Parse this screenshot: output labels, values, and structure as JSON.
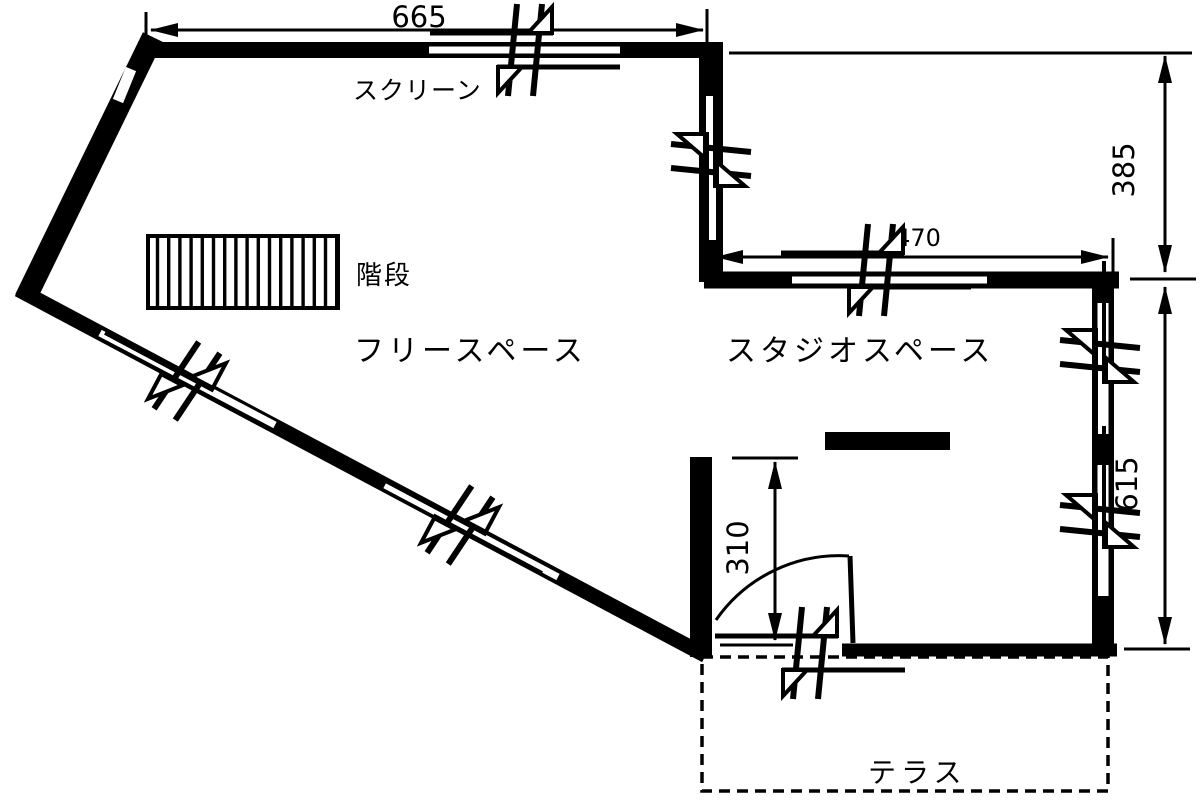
{
  "floorplan": {
    "colors": {
      "ink": "#000000",
      "background": "#ffffff"
    },
    "rooms": {
      "free_space": "フリースペース",
      "studio_space": "スタジオスペース",
      "terrace": "テラス"
    },
    "labels": {
      "screen": "スクリーン",
      "stairs": "階段"
    },
    "dimensions": {
      "top_width": "665",
      "right_upper_height": "385",
      "studio_width": "470",
      "right_lower_height": "615",
      "entry_opening": "310"
    }
  }
}
